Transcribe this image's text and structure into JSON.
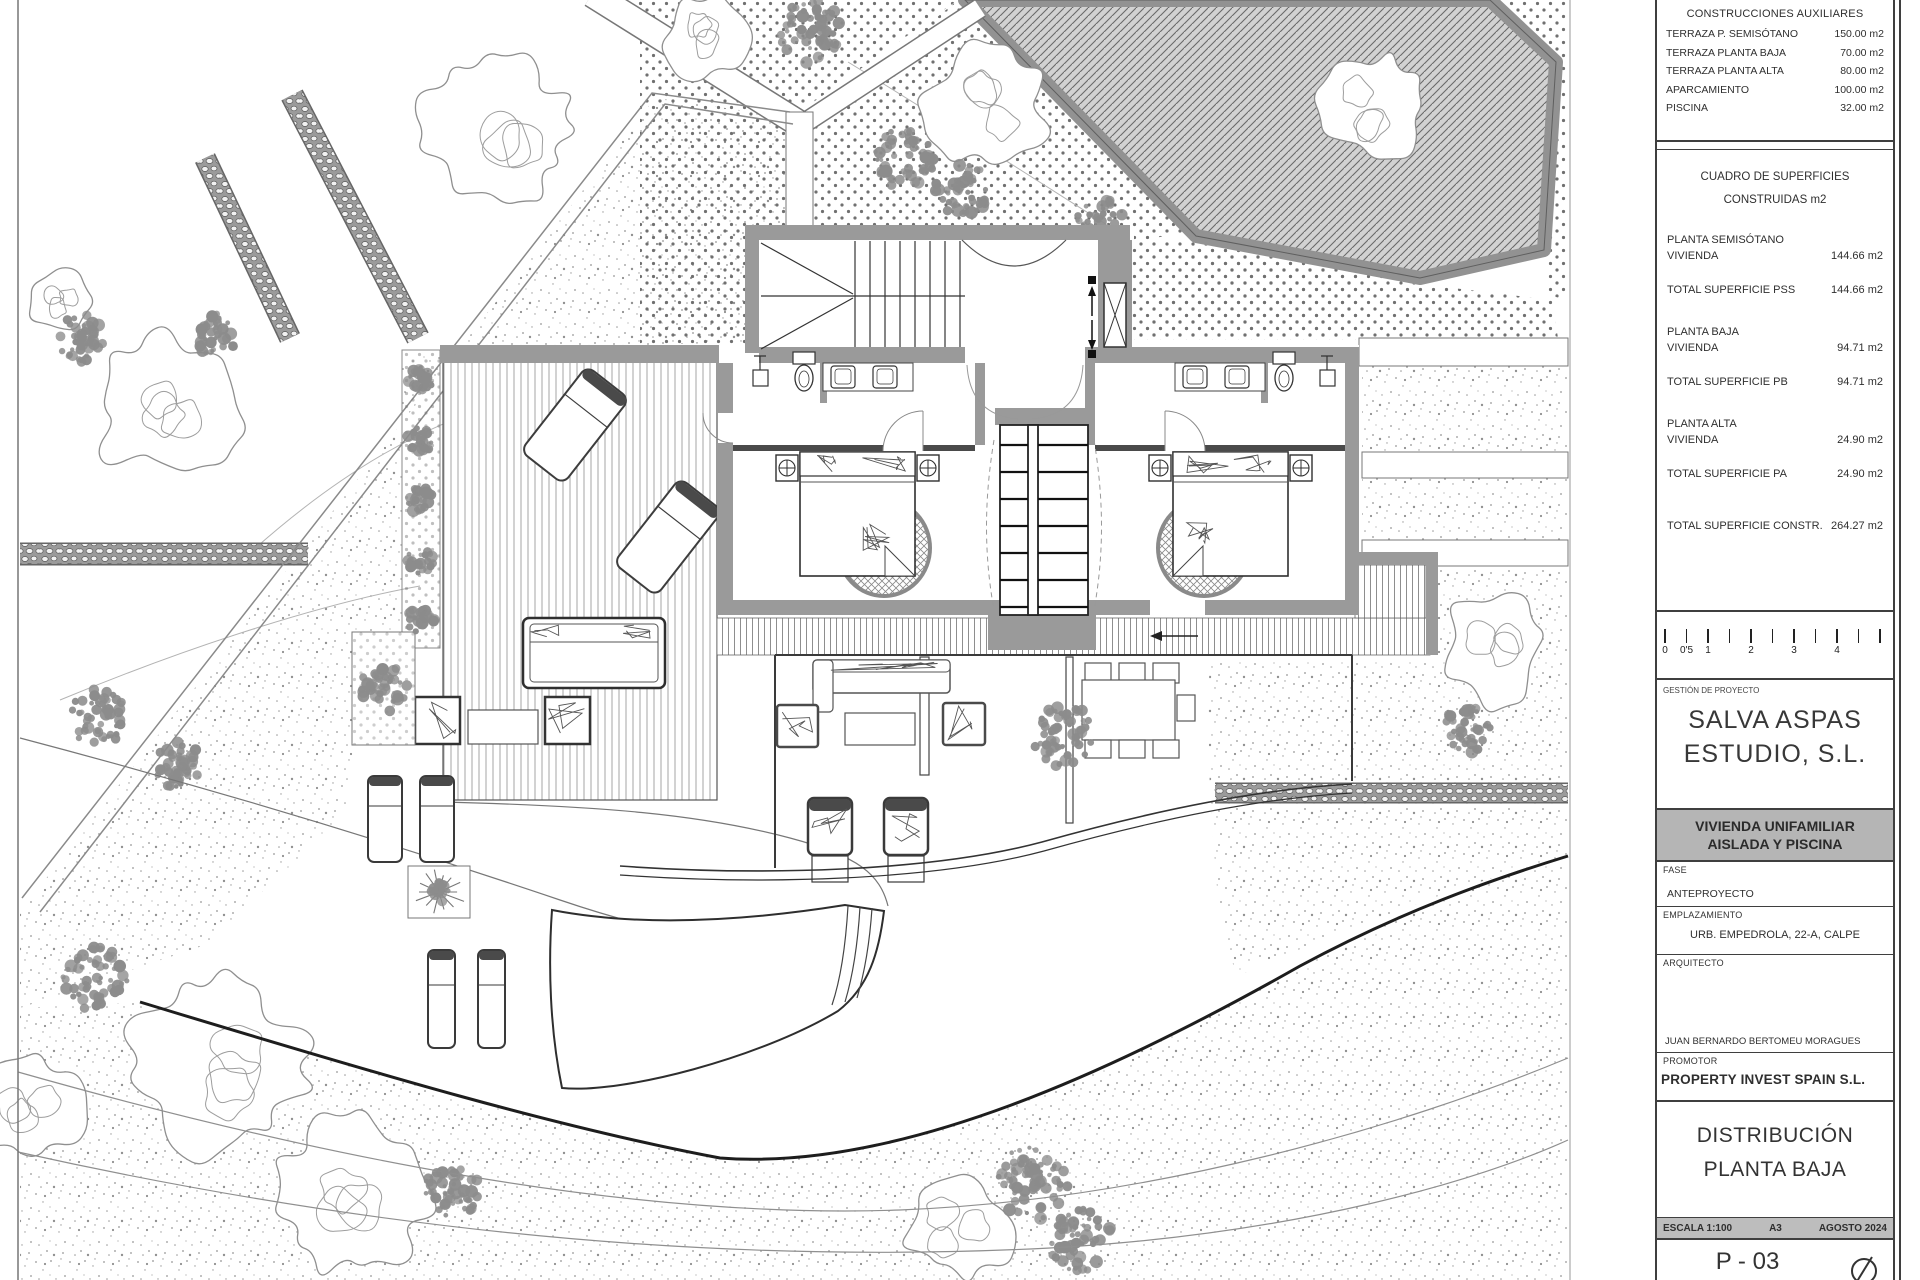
{
  "title_block": {
    "aux": {
      "title": "CONSTRUCCIONES AUXILIARES",
      "rows": [
        {
          "label": "TERRAZA P. SEMISÓTANO",
          "value": "150.00 m2"
        },
        {
          "label": "TERRAZA PLANTA BAJA",
          "value": "70.00 m2"
        },
        {
          "label": "TERRAZA PLANTA ALTA",
          "value": "80.00 m2"
        },
        {
          "label": "APARCAMIENTO",
          "value": "100.00 m2"
        },
        {
          "label": "PISCINA",
          "value": "32.00 m2"
        }
      ]
    },
    "surfaces": {
      "title_line1": "CUADRO DE SUPERFICIES",
      "title_line2": "CONSTRUIDAS m2",
      "rows": [
        {
          "label": "PLANTA SEMISÓTANO",
          "value": "",
          "cls": "g"
        },
        {
          "label": "VIVIENDA",
          "value": "144.66 m2",
          "cls": ""
        },
        {
          "label": "TOTAL SUPERFICIE PSS",
          "value": "144.66 m2",
          "cls": "t"
        },
        {
          "label": "PLANTA BAJA",
          "value": "",
          "cls": "g"
        },
        {
          "label": "VIVIENDA",
          "value": "94.71 m2",
          "cls": ""
        },
        {
          "label": "TOTAL SUPERFICIE PB",
          "value": "94.71 m2",
          "cls": "t"
        },
        {
          "label": "PLANTA ALTA",
          "value": "",
          "cls": "g"
        },
        {
          "label": "VIVIENDA",
          "value": "24.90 m2",
          "cls": ""
        },
        {
          "label": "TOTAL SUPERFICIE PA",
          "value": "24.90 m2",
          "cls": "t"
        },
        {
          "label": "TOTAL SUPERFICIE CONSTR.",
          "value": "264.27 m2",
          "cls": "gg"
        }
      ]
    },
    "scale_bar": {
      "tick_count": 11,
      "labels": [
        {
          "text": "0",
          "tick": 0
        },
        {
          "text": "0'5",
          "tick": 1
        },
        {
          "text": "1",
          "tick": 2
        },
        {
          "text": "2",
          "tick": 4
        },
        {
          "text": "3",
          "tick": 6
        },
        {
          "text": "4",
          "tick": 8
        }
      ]
    },
    "management": {
      "label": "GESTIÓN DE PROYECTO",
      "name_line1": "SALVA ASPAS",
      "name_line2": "ESTUDIO, S.L."
    },
    "project": {
      "title_line1": "VIVIENDA UNIFAMILIAR",
      "title_line2": "AISLADA Y PISCINA"
    },
    "fase": {
      "label": "FASE",
      "value": "ANTEPROYECTO"
    },
    "emplazamiento": {
      "label": "EMPLAZAMIENTO",
      "value": "URB. EMPEDROLA, 22-A, CALPE"
    },
    "arquitecto": {
      "label": "ARQUITECTO",
      "value": "JUAN BERNARDO BERTOMEU MORAGUES"
    },
    "promotor": {
      "label": "PROMOTOR",
      "value": "PROPERTY INVEST SPAIN S.L."
    },
    "drawing": {
      "title_line1": "DISTRIBUCIÓN",
      "title_line2": "PLANTA BAJA"
    },
    "meta": {
      "escala": "ESCALA 1:100",
      "formato": "A3",
      "fecha": "AGOSTO 2024"
    },
    "sheet_number": "P - 03"
  },
  "colors": {
    "wall_gray": "#9a9a9a",
    "line_dark": "#3a3a3a",
    "tree_outline": "#8f8f8f",
    "bush_gray": "#8c8c8c",
    "panel_header_bg": "#b5b5b5",
    "meta_bar_bg": "#bdbdbd",
    "hatch_bg": "#d2d2d2"
  }
}
